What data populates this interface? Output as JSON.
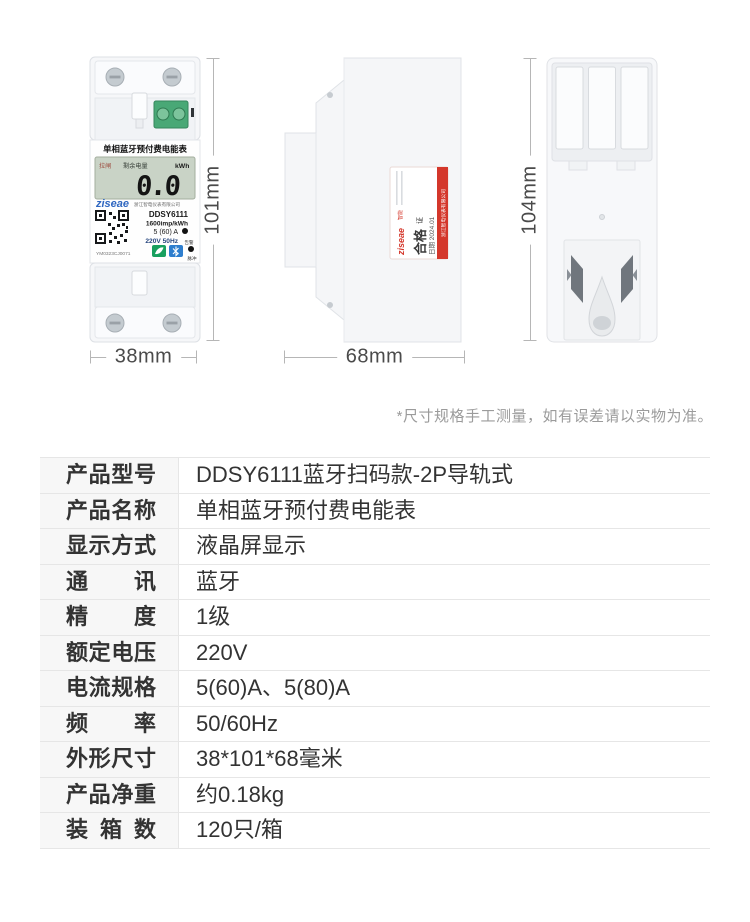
{
  "note": "*尺寸规格手工测量，如有误差请以实物为准。",
  "dimensions": {
    "front_height": "101mm",
    "front_width": "38mm",
    "side_width": "68mm",
    "back_height": "104mm"
  },
  "front_meter": {
    "title": "单相蓝牙预付费电能表",
    "lcd_status": "拉闸",
    "lcd_label": "剩余电量",
    "lcd_unit": "kWh",
    "lcd_value": "0.0",
    "brand": "ziseae",
    "company": "浙江智电仪表有限公司",
    "model": "DDSY6111",
    "meter_constant": "1600imp/kWh",
    "current_spec": "5 (60) A",
    "voltage_spec": "220V 50Hz",
    "alarm_label": "告警",
    "pulse_label": "脉冲",
    "serial": "YM0323CJ0071"
  },
  "side_label": {
    "brand": "ziseae",
    "brand_suffix": "智能",
    "cert_title_main": "合格",
    "cert_title_sub": "证",
    "date": "日期 2024.01",
    "company_band": "浙江智电仪表有限公司"
  },
  "colors": {
    "accent_red": "#d4372b",
    "brand_blue": "#2e66c0",
    "terminal_green": "#49a876",
    "lcd_green": "#c9d3c6"
  },
  "spec_table": {
    "rows": [
      {
        "label": "产品型号",
        "value": "DDSY6111蓝牙扫码款-2P导轨式"
      },
      {
        "label": "产品名称",
        "value": "单相蓝牙预付费电能表"
      },
      {
        "label": "显示方式",
        "value": "液晶屏显示"
      },
      {
        "label": "通讯",
        "value": "蓝牙"
      },
      {
        "label": "精度",
        "value": "1级"
      },
      {
        "label": "额定电压",
        "value": "220V"
      },
      {
        "label": "电流规格",
        "value": "5(60)A、5(80)A"
      },
      {
        "label": "频率",
        "value": "50/60Hz"
      },
      {
        "label": "外形尺寸",
        "value": "38*101*68毫米"
      },
      {
        "label": "产品净重",
        "value": "约0.18kg"
      },
      {
        "label": "装箱数",
        "value": "120只/箱"
      }
    ]
  }
}
